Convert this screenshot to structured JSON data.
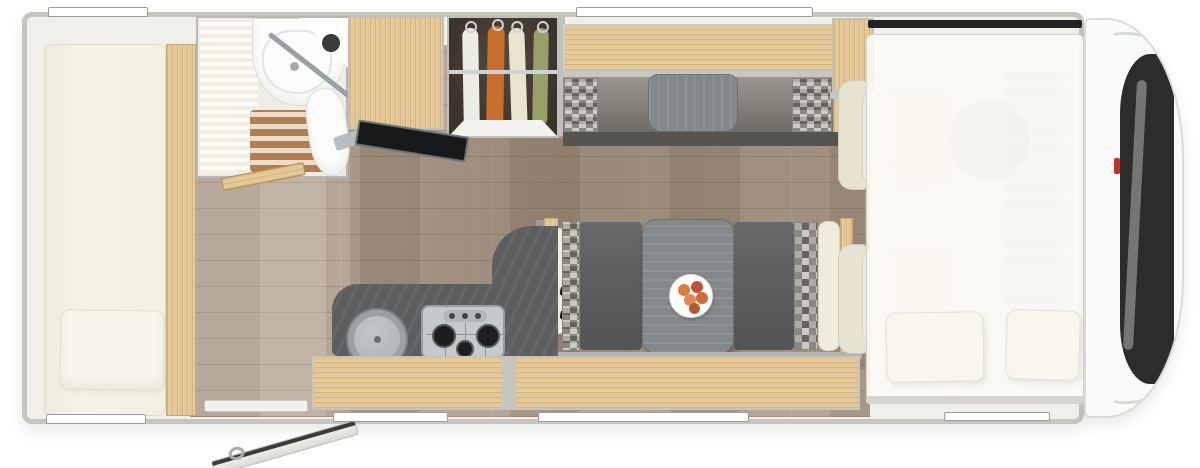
{
  "meta": {
    "title": "Motorhome floor plan - top view",
    "width": 1200,
    "height": 468,
    "visible_text": "none"
  },
  "palette": {
    "bg": "#ffffff",
    "bodyWall": "#c7c5c0",
    "bodyFill": "#f1efe9",
    "woodLight": "#e3c796",
    "woodDark": "#b98a5d",
    "floorBase": "#b1a191",
    "floorShade": "#5c4a3a",
    "slatBrown": "#b57e52",
    "counterGray": "#5c5e60",
    "tableGray": "#85888a",
    "seatGray": "#5d5f61",
    "matGray": "#56544f",
    "checkLight": "#c2beb7",
    "checkDark": "#716d66",
    "cream": "#f0ecdd",
    "creamShade": "#d9d4c2",
    "white": "#fbfbfa",
    "steel": "#c6c9cb",
    "burnerBlack": "#1d1d1d",
    "windshield": "#2c2c2a",
    "chrome": "#d7dadc",
    "logoRed": "#c23227",
    "shirtWhite": "#ecebe4",
    "shirtOrange": "#c96f2e",
    "shirtCream": "#e9e3d1",
    "shirtGreen": "#97a06a",
    "fruitOrange": "#d97c44",
    "fruitRed": "#c2503a"
  },
  "inventory": {
    "areas": [
      {
        "name": "rear-bed",
        "desc": "longitudinal bed with pillow, left end"
      },
      {
        "name": "bathroom",
        "desc": "washroom with corner basin, toilet, slatted shower floor, blind screen"
      },
      {
        "name": "fridge-cabinet",
        "desc": "tall wood cabinet next to bathroom"
      },
      {
        "name": "wardrobe",
        "desc": "open wardrobe with hanging rail"
      },
      {
        "name": "tv-unit",
        "desc": "swing-out flat screen TV"
      },
      {
        "name": "kitchen",
        "desc": "curved dark counter with round sink and 3-burner gas hob"
      },
      {
        "name": "dinette",
        "desc": "two facing bench seats with grey table and fruit plate"
      },
      {
        "name": "cab-seats",
        "desc": "two swivelled cream cab seats"
      },
      {
        "name": "overcab-bed",
        "desc": "translucent drop-down bed with two pillows over the cab"
      },
      {
        "name": "cab-front",
        "desc": "vehicle nose with windscreen, chrome trim and red badge"
      },
      {
        "name": "entry-door",
        "desc": "entry door drawn open on lower wall"
      }
    ],
    "counts": {
      "hanging_shirts": 4,
      "hob_burners": 3,
      "overcab_pillows": 2,
      "wall_windows": 6,
      "fruits_on_plate": 5,
      "cab_seats": 2
    },
    "shirt_colors": [
      "white",
      "orange",
      "cream",
      "green"
    ]
  }
}
